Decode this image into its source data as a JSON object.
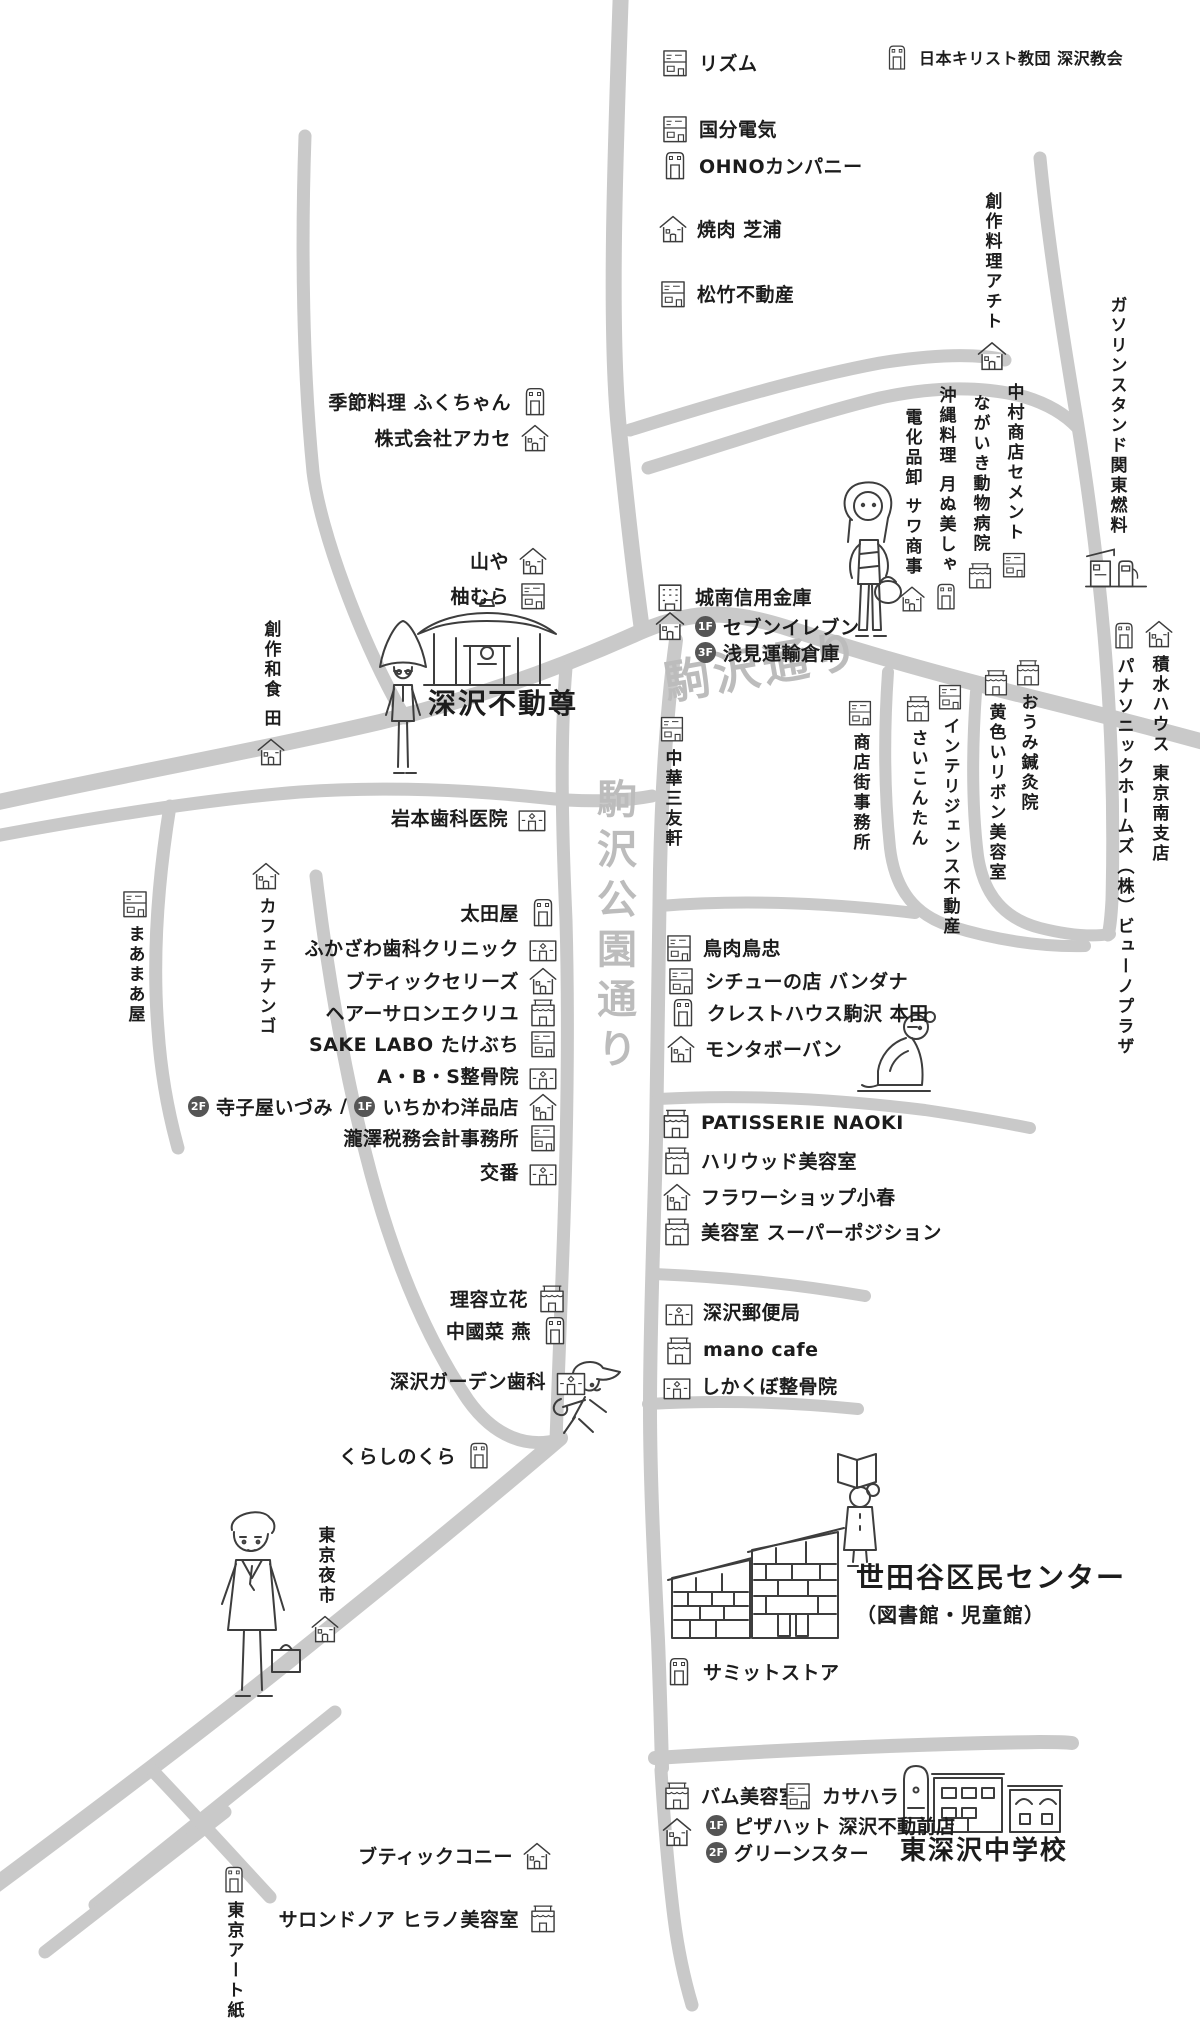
{
  "colors": {
    "road": "#c9c9c9",
    "street_label": "#bcbcbc",
    "text": "#1c1c1c",
    "badge": "#555555",
    "background": "#ffffff"
  },
  "streets": {
    "komazawa": "駒沢通り",
    "koen": "駒沢公園通り"
  },
  "badges": {
    "f1": "1F",
    "f2": "2F",
    "f3": "3F"
  },
  "separator": "/",
  "landmarks": {
    "fudoson": "深沢不動尊",
    "civic": "世田谷区民センター",
    "civic_sub": "（図書館・児童館）",
    "school": "東深沢中学校"
  },
  "places": {
    "rhythm": "リズム",
    "church": "日本キリスト教団 深沢教会",
    "kokubu": "国分電気",
    "ohno": "OHNOカンパニー",
    "yakiniku": "焼肉 芝浦",
    "shochiku": "松竹不動産",
    "achito": "創作料理アチト",
    "gasoline": "ガソリンスタンド関東燃料",
    "nakamura": "中村商店セメント",
    "nagaiki": "ながいき動物病院",
    "okinawa": "沖縄料理 月ぬ美しゃ",
    "denka": "電化品卸 サワ商事",
    "fukuchan": "季節料理 ふくちゃん",
    "akase": "株式会社アカセ",
    "yamaya": "山や",
    "yuzumura": "柚むら",
    "sousaku_den": "創作和食 田",
    "jonan": "城南信用金庫",
    "seven": "セブンイレブン",
    "asami": "浅見運輸倉庫",
    "shotengai": "商店街事務所",
    "chuka": "中華三友軒",
    "saikontan": "さいこんたん",
    "intelligence": "インテリジェンス不動産",
    "kiiroi": "黄色いリボン美容室",
    "oumi": "おうみ鍼灸院",
    "sekisui": "積水ハウス 東京南支店",
    "panasonic": "パナソニックホームズ（株）ビューノプラザ",
    "iwamoto": "岩本歯科医院",
    "cafetenango": "カフェテナンゴ",
    "maamaa": "まあまあ屋",
    "ootaya": "太田屋",
    "fukazawa_dental": "ふかざわ歯科クリニック",
    "boutique_series": "ブティックセリーズ",
    "ecru": "ヘアーサロンエクリユ",
    "sakelabo": "SAKE LABO たけぶち",
    "abs": "A・B・S整骨院",
    "terakoya": "寺子屋いづみ",
    "ichikawa": "いちかわ洋品店",
    "takizawa": "瀧澤税務会計事務所",
    "koban": "交番",
    "toriniku": "鳥肉鳥忠",
    "stew": "シチューの店 バンダナ",
    "crest": "クレストハウス駒沢 本田",
    "montaboban": "モンタボーバン",
    "patisserie": "PATISSERIE NAOKI",
    "hollywood": "ハリウッド美容室",
    "flower": "フラワーショップ小春",
    "superposition": "美容室 スーパーポジション",
    "tachibana": "理容立花",
    "chugoku": "中國菜 燕",
    "garden_dental": "深沢ガーデン歯科",
    "post": "深沢郵便局",
    "mano": "mano cafe",
    "shikakubo": "しかくぼ整骨院",
    "kurashi": "くらしのくら",
    "yoichi": "東京夜市",
    "summit": "サミットストア",
    "bam": "バム美容室",
    "kasahara": "カサハラ",
    "pizzahut": "ピザハット 深沢不動前店",
    "greenstar": "グリーンスター",
    "connie": "ブティックコニー",
    "salon_noa": "サロンドノア ヒラノ美容室",
    "tokyo_art": "東京アート紙行"
  }
}
